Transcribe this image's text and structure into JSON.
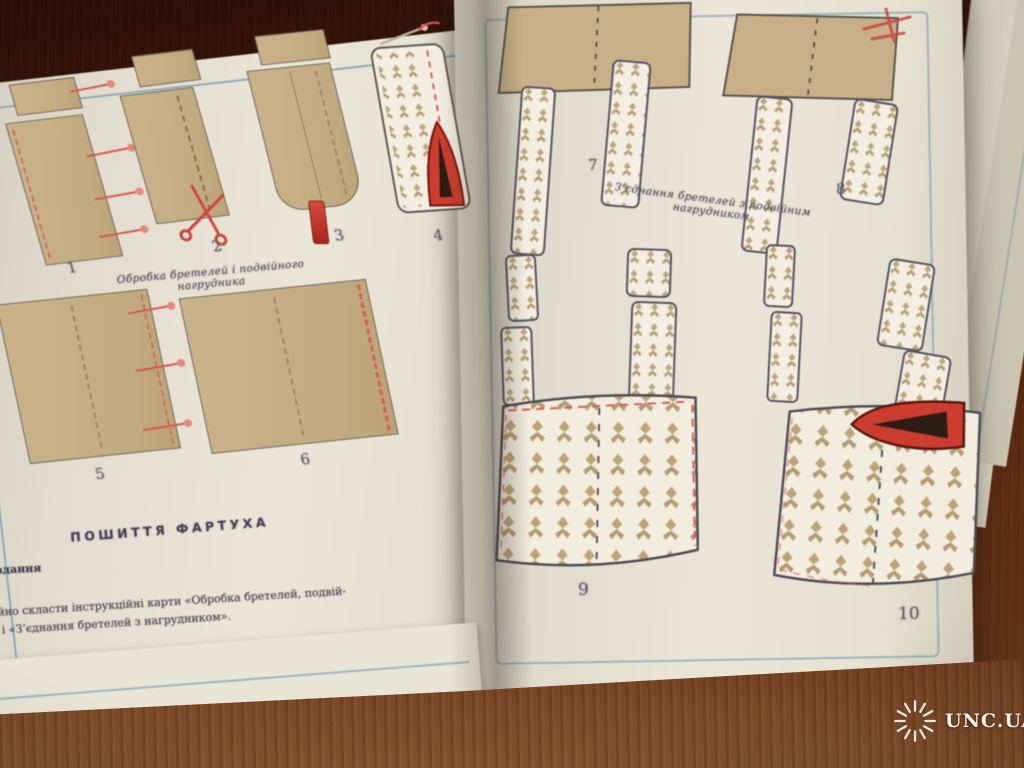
{
  "book": {
    "left_page": {
      "figures": [
        {
          "label": "1"
        },
        {
          "label": "2"
        },
        {
          "label": "3"
        },
        {
          "label": "4"
        },
        {
          "label": "5"
        },
        {
          "label": "6"
        }
      ],
      "caption_straps": "Обробка бретелей і подвійного нагрудника",
      "section_heading": "ПОШИТТЯ ФАРТУХА",
      "sidebar_word": "Завдання",
      "paragraph": {
        "line1": "самостійно скласти інструкційні карти «Обробка бретелей, подвій-",
        "line2": "ником» і «З’єднання бретелей з нагрудником»."
      }
    },
    "right_page": {
      "figures": [
        {
          "label": "7"
        },
        {
          "label": "8"
        },
        {
          "label": "9"
        },
        {
          "label": "10"
        }
      ],
      "caption_join": "З’єднання бретелей з подвійним нагрудником"
    }
  },
  "watermark": {
    "text": "UNC.UA",
    "icon": "sunburst-icon"
  },
  "icons": {
    "scissors": "scissors-icon",
    "iron": "iron-icon",
    "turning_tube": "turning-tube-icon",
    "pin": "pin-icon",
    "sunburst": "sunburst-icon"
  },
  "colors": {
    "wood": "#5a2a12",
    "page": "#e9e4d5",
    "frame_blue": "#7aa0b8",
    "fabric_tan": "#c8b183",
    "floral_bg": "#f3eee0",
    "floral_motif": "#bda273",
    "accent_red": "#d63a2c",
    "ink": "#4e4a5c"
  }
}
